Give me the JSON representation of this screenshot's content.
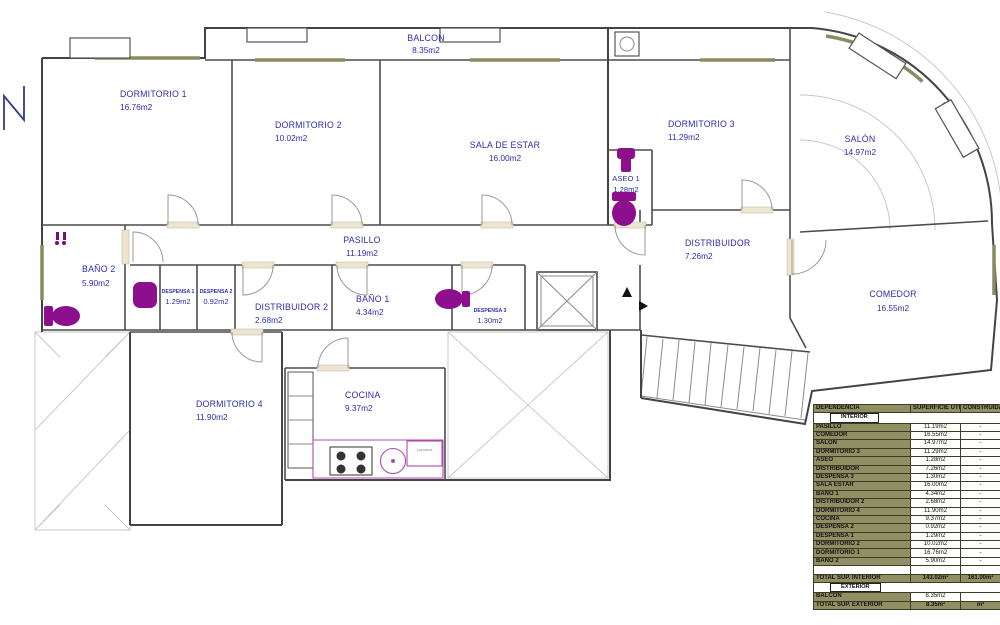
{
  "plan": {
    "rooms": {
      "balcon": {
        "name": "BALCON",
        "area": "8.35m2"
      },
      "dormitorio1": {
        "name": "DORMITORIO 1",
        "area": "16.76m2"
      },
      "dormitorio2": {
        "name": "DORMITORIO 2",
        "area": "10.02m2"
      },
      "sala_estar": {
        "name": "SALA DE ESTAR",
        "area": "16.00m2"
      },
      "dormitorio3": {
        "name": "DORMITORIO 3",
        "area": "11.29m2"
      },
      "salon": {
        "name": "SALÓN",
        "area": "14.97m2"
      },
      "aseo1": {
        "name": "ASEO 1",
        "area": "1.28m2"
      },
      "pasillo": {
        "name": "PASILLO",
        "area": "11.19m2"
      },
      "distribuidor": {
        "name": "DISTRIBUIDOR",
        "area": "7.26m2"
      },
      "bano2": {
        "name": "BAÑO 2",
        "area": "5.90m2"
      },
      "despensa1": {
        "name": "DESPENSA 1",
        "area": "1.29m2"
      },
      "despensa2": {
        "name": "DESPENSA 2",
        "area": "0.92m2"
      },
      "distribuidor2": {
        "name": "DISTRIBUIDOR 2",
        "area": "2.68m2"
      },
      "bano1": {
        "name": "BAÑO 1",
        "area": "4.34m2"
      },
      "despensa3": {
        "name": "DESPENSA 3",
        "area": "1.30m2"
      },
      "comedor": {
        "name": "COMEDOR",
        "area": "16.55m2"
      },
      "dormitorio4": {
        "name": "DORMITORIO 4",
        "area": "11.90m2"
      },
      "cocina": {
        "name": "COCINA",
        "area": "9.37m2"
      }
    },
    "lavadora_label": "Lavadora"
  },
  "table": {
    "headers": {
      "dependencia": "DEPENDENCIA",
      "superficie": "SUPERFICIE ÚTIL",
      "construida": "CONSTRUIDA"
    },
    "sections": {
      "interior": "INTERIOR",
      "exterior": "EXTERIOR"
    },
    "interior_rows": [
      {
        "name": "PASILLO",
        "util": "11.19m2",
        "construida": "-"
      },
      {
        "name": "COMEDOR",
        "util": "16.55m2",
        "construida": "-"
      },
      {
        "name": "SALÓN",
        "util": "14.97m2",
        "construida": "-"
      },
      {
        "name": "DORMITORIO 3",
        "util": "11.29m2",
        "construida": "-"
      },
      {
        "name": "ASEO",
        "util": "1.28m2",
        "construida": "-"
      },
      {
        "name": "DISTRIBUIDOR",
        "util": "7.26m2",
        "construida": "-"
      },
      {
        "name": "DESPENSA 3",
        "util": "1.30m2",
        "construida": "-"
      },
      {
        "name": "SALA ESTAR",
        "util": "16.00m2",
        "construida": "-"
      },
      {
        "name": "BAÑO 1",
        "util": "4.34m2",
        "construida": "-"
      },
      {
        "name": "DISTRIBUIDOR 2",
        "util": "2.68m2",
        "construida": "-"
      },
      {
        "name": "DORMITORIO 4",
        "util": "11.90m2",
        "construida": "-"
      },
      {
        "name": "COCINA",
        "util": "9.37m2",
        "construida": "-"
      },
      {
        "name": "DESPENSA 2",
        "util": "0.92m2",
        "construida": "-"
      },
      {
        "name": "DESPENSA 1",
        "util": "1.29m2",
        "construida": "-"
      },
      {
        "name": "DORMITORIO 2",
        "util": "10.02m2",
        "construida": "-"
      },
      {
        "name": "DORMITORIO 1",
        "util": "16.76m2",
        "construida": "-"
      },
      {
        "name": "BAÑO 2",
        "util": "5.90m2",
        "construida": "-"
      },
      {
        "name": "",
        "util": "",
        "construida": ""
      }
    ],
    "total_interior": {
      "label": "TOTAL SUP. INTERIOR",
      "util": "143.02m²",
      "construida": "161.00m²"
    },
    "exterior_rows": [
      {
        "name": "BALCON",
        "util": "8.35m2",
        "construida": ""
      }
    ],
    "total_exterior": {
      "label": "TOTAL SUP. EXTERIOR",
      "util": "8.35m²",
      "construida": "m²"
    }
  },
  "colors": {
    "label_blue": "#2e2eae",
    "table_olive": "#8f8f63",
    "fixture_purple": "#8e0f8e",
    "sill_olive": "#8b8b5f"
  }
}
